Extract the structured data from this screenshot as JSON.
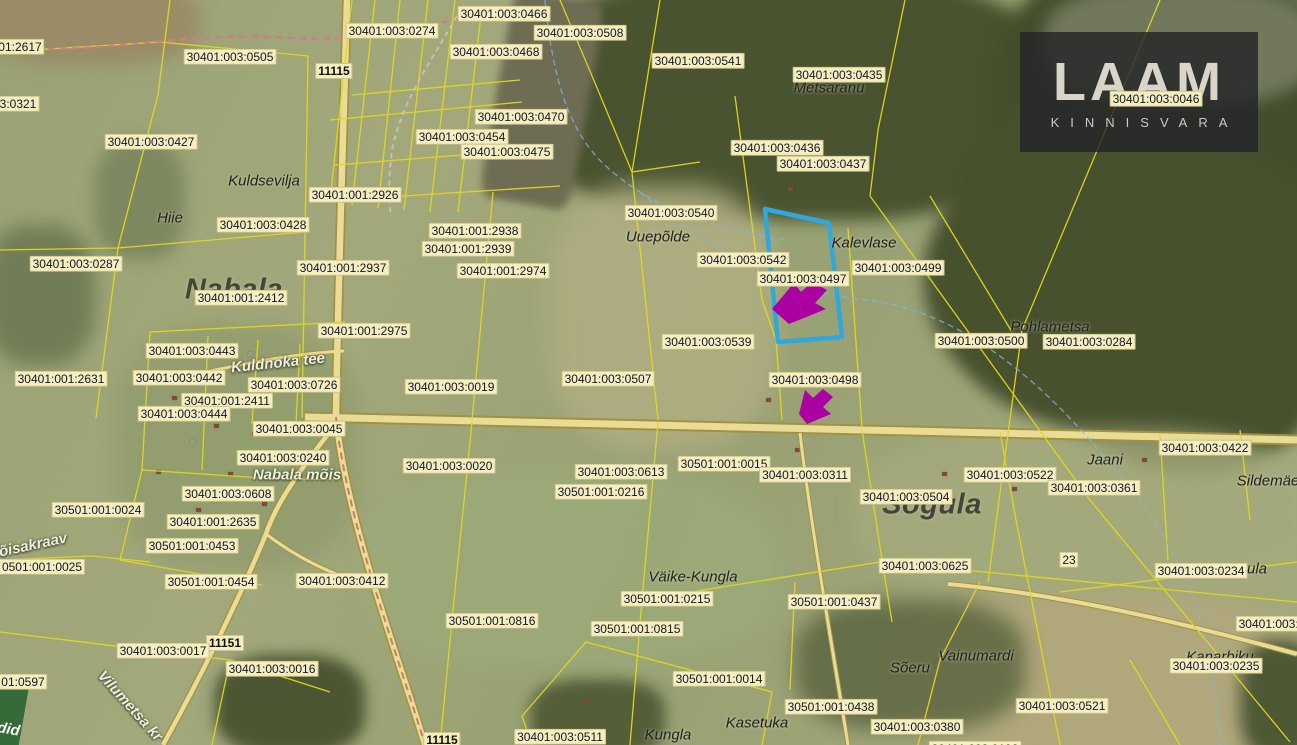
{
  "branding": {
    "logo_text": "LAAM",
    "logo_sub": "KINNISVARA"
  },
  "corner": {
    "text": "did"
  },
  "colors": {
    "label_bg": "#f5eebe",
    "boundary_yellow": "#e3d81c",
    "road_fill": "#e8dc96",
    "road_casing": "#a39043",
    "highlight_blue": "#2fa8dd",
    "arrow_magenta": "#ab00a2",
    "stream_blue": "#7fb6d9",
    "logo_bg": "rgba(35,36,40,0.82)"
  },
  "map": {
    "highlight": {
      "outline_points": "765,209 829,223 842,337 778,342",
      "arrow_points": [
        "772,309 794,283 801,292 812,282 827,290 815,303 826,309 789,324",
        "799,414 805,390 813,398 823,389 833,397 823,407 831,414 807,424"
      ]
    },
    "place_labels": [
      {
        "text": "Nabala",
        "x": 234,
        "y": 290
      },
      {
        "text": "Sõgula",
        "x": 932,
        "y": 505
      }
    ],
    "farm_labels": [
      {
        "text": "Kuldsevilja",
        "x": 264,
        "y": 181
      },
      {
        "text": "Hiie",
        "x": 170,
        "y": 218
      },
      {
        "text": "Metsaranu",
        "x": 829,
        "y": 88
      },
      {
        "text": "Uuepõlde",
        "x": 658,
        "y": 237
      },
      {
        "text": "Kalevlase",
        "x": 864,
        "y": 243
      },
      {
        "text": "Pohlametsa",
        "x": 1050,
        "y": 327
      },
      {
        "text": "Jaani",
        "x": 1105,
        "y": 460
      },
      {
        "text": "Sildemäe",
        "x": 1268,
        "y": 481
      },
      {
        "text": "Väike-Kungla",
        "x": 693,
        "y": 577
      },
      {
        "text": "Vainumardi",
        "x": 976,
        "y": 656
      },
      {
        "text": "Sõeru",
        "x": 910,
        "y": 668
      },
      {
        "text": "Kungla",
        "x": 668,
        "y": 735
      },
      {
        "text": "Kasetuka",
        "x": 757,
        "y": 723
      },
      {
        "text": "Kanarbiku",
        "x": 1220,
        "y": 657
      },
      {
        "text": "ula",
        "x": 1257,
        "y": 569
      }
    ],
    "road_name_labels": [
      {
        "text": "Nabala mõis",
        "x": 297,
        "y": 475
      },
      {
        "text": "Kuldnoka tee",
        "x": 278,
        "y": 363,
        "rot": -6
      },
      {
        "text": "Vilumetsa kr",
        "x": 130,
        "y": 706,
        "rot": 48
      },
      {
        "text": "õisakraav",
        "x": 33,
        "y": 545,
        "rot": -12
      }
    ],
    "road_number_labels": [
      {
        "text": "11115",
        "x": 334,
        "y": 71
      },
      {
        "text": "11151",
        "x": 225,
        "y": 643
      },
      {
        "text": "11115",
        "x": 442,
        "y": 740
      }
    ],
    "parcel_labels": [
      {
        "text": "01:2617",
        "x": 20,
        "y": 47
      },
      {
        "text": "30401:003:0274",
        "x": 392,
        "y": 31
      },
      {
        "text": "30401:003:0466",
        "x": 504,
        "y": 14
      },
      {
        "text": "30401:003:0508",
        "x": 580,
        "y": 33
      },
      {
        "text": "30401:003:0505",
        "x": 230,
        "y": 57
      },
      {
        "text": "30401:003:0468",
        "x": 496,
        "y": 52
      },
      {
        "text": "30401:003:0541",
        "x": 698,
        "y": 61
      },
      {
        "text": "30401:003:0435",
        "x": 839,
        "y": 75
      },
      {
        "text": "30401:003:0046",
        "x": 1156,
        "y": 99
      },
      {
        "text": "3:0321",
        "x": 18,
        "y": 104
      },
      {
        "text": "30401:003:0470",
        "x": 521,
        "y": 117
      },
      {
        "text": "30401:003:0454",
        "x": 462,
        "y": 137
      },
      {
        "text": "30401:003:0427",
        "x": 151,
        "y": 142
      },
      {
        "text": "30401:003:0475",
        "x": 507,
        "y": 152
      },
      {
        "text": "30401:003:0436",
        "x": 777,
        "y": 148
      },
      {
        "text": "30401:003:0437",
        "x": 823,
        "y": 164
      },
      {
        "text": "30401:001:2926",
        "x": 355,
        "y": 195
      },
      {
        "text": "30401:003:0540",
        "x": 671,
        "y": 213
      },
      {
        "text": "30401:003:0428",
        "x": 263,
        "y": 225
      },
      {
        "text": "30401:001:2938",
        "x": 475,
        "y": 231
      },
      {
        "text": "30401:001:2939",
        "x": 468,
        "y": 249
      },
      {
        "text": "30401:003:0287",
        "x": 76,
        "y": 264
      },
      {
        "text": "30401:001:2937",
        "x": 343,
        "y": 268
      },
      {
        "text": "30401:003:0499",
        "x": 898,
        "y": 268
      },
      {
        "text": "30401:001:2974",
        "x": 503,
        "y": 271
      },
      {
        "text": "30401:003:0542",
        "x": 743,
        "y": 260
      },
      {
        "text": "30401:003:0497",
        "x": 803,
        "y": 279
      },
      {
        "text": "30401:001:2412",
        "x": 241,
        "y": 298
      },
      {
        "text": "30401:001:2975",
        "x": 364,
        "y": 331
      },
      {
        "text": "30401:003:0539",
        "x": 708,
        "y": 342
      },
      {
        "text": "30401:003:0500",
        "x": 981,
        "y": 341
      },
      {
        "text": "30401:003:0284",
        "x": 1089,
        "y": 342
      },
      {
        "text": "30401:003:0443",
        "x": 192,
        "y": 351
      },
      {
        "text": "30401:001:2631",
        "x": 61,
        "y": 379
      },
      {
        "text": "30401:003:0442",
        "x": 179,
        "y": 378
      },
      {
        "text": "30401:003:0726",
        "x": 294,
        "y": 385
      },
      {
        "text": "30401:003:0019",
        "x": 451,
        "y": 387
      },
      {
        "text": "30401:003:0507",
        "x": 608,
        "y": 379
      },
      {
        "text": "30401:003:0498",
        "x": 815,
        "y": 380
      },
      {
        "text": "30401:001:2411",
        "x": 227,
        "y": 401
      },
      {
        "text": "30401:003:0444",
        "x": 184,
        "y": 414
      },
      {
        "text": "30401:003:0045",
        "x": 299,
        "y": 429
      },
      {
        "text": "30401:003:0240",
        "x": 283,
        "y": 458
      },
      {
        "text": "30401:003:0020",
        "x": 449,
        "y": 466
      },
      {
        "text": "30501:001:0015",
        "x": 724,
        "y": 464
      },
      {
        "text": "30401:003:0613",
        "x": 621,
        "y": 472
      },
      {
        "text": "30401:003:0311",
        "x": 805,
        "y": 475
      },
      {
        "text": "30501:001:0216",
        "x": 601,
        "y": 492
      },
      {
        "text": "30401:003:0504",
        "x": 906,
        "y": 497
      },
      {
        "text": "30401:003:0522",
        "x": 1010,
        "y": 475
      },
      {
        "text": "30401:003:0361",
        "x": 1094,
        "y": 488
      },
      {
        "text": "30401:003:0422",
        "x": 1205,
        "y": 448
      },
      {
        "text": "30401:003:0608",
        "x": 228,
        "y": 494
      },
      {
        "text": "30501:001:0024",
        "x": 98,
        "y": 510
      },
      {
        "text": "30401:001:2635",
        "x": 213,
        "y": 522
      },
      {
        "text": "30501:001:0453",
        "x": 192,
        "y": 546
      },
      {
        "text": "0501:001:0025",
        "x": 42,
        "y": 567
      },
      {
        "text": "30501:001:0454",
        "x": 211,
        "y": 582
      },
      {
        "text": "30401:003:0412",
        "x": 342,
        "y": 581
      },
      {
        "text": "30401:003:0625",
        "x": 925,
        "y": 566
      },
      {
        "text": "30401:003:0234",
        "x": 1201,
        "y": 571
      },
      {
        "text": "23",
        "x": 1069,
        "y": 560
      },
      {
        "text": "30501:001:0215",
        "x": 667,
        "y": 599
      },
      {
        "text": "30501:001:0437",
        "x": 834,
        "y": 602
      },
      {
        "text": "30501:001:0815",
        "x": 637,
        "y": 629
      },
      {
        "text": "30501:001:0816",
        "x": 492,
        "y": 621
      },
      {
        "text": "30401:003:0017",
        "x": 163,
        "y": 651
      },
      {
        "text": "30401:003:0016",
        "x": 272,
        "y": 669
      },
      {
        "text": "01:0597",
        "x": 23,
        "y": 682
      },
      {
        "text": "30501:001:0014",
        "x": 719,
        "y": 679
      },
      {
        "text": "30401:003:0235",
        "x": 1216,
        "y": 666
      },
      {
        "text": "30401:003:0521",
        "x": 1062,
        "y": 706
      },
      {
        "text": "30401:003:0",
        "x": 1272,
        "y": 624
      },
      {
        "text": "30501:001:0438",
        "x": 831,
        "y": 707
      },
      {
        "text": "30401:003:0511",
        "x": 560,
        "y": 737
      },
      {
        "text": "30401:003:0380",
        "x": 917,
        "y": 727
      },
      {
        "text": "30401:003:0192",
        "x": 975,
        "y": 749
      }
    ]
  }
}
